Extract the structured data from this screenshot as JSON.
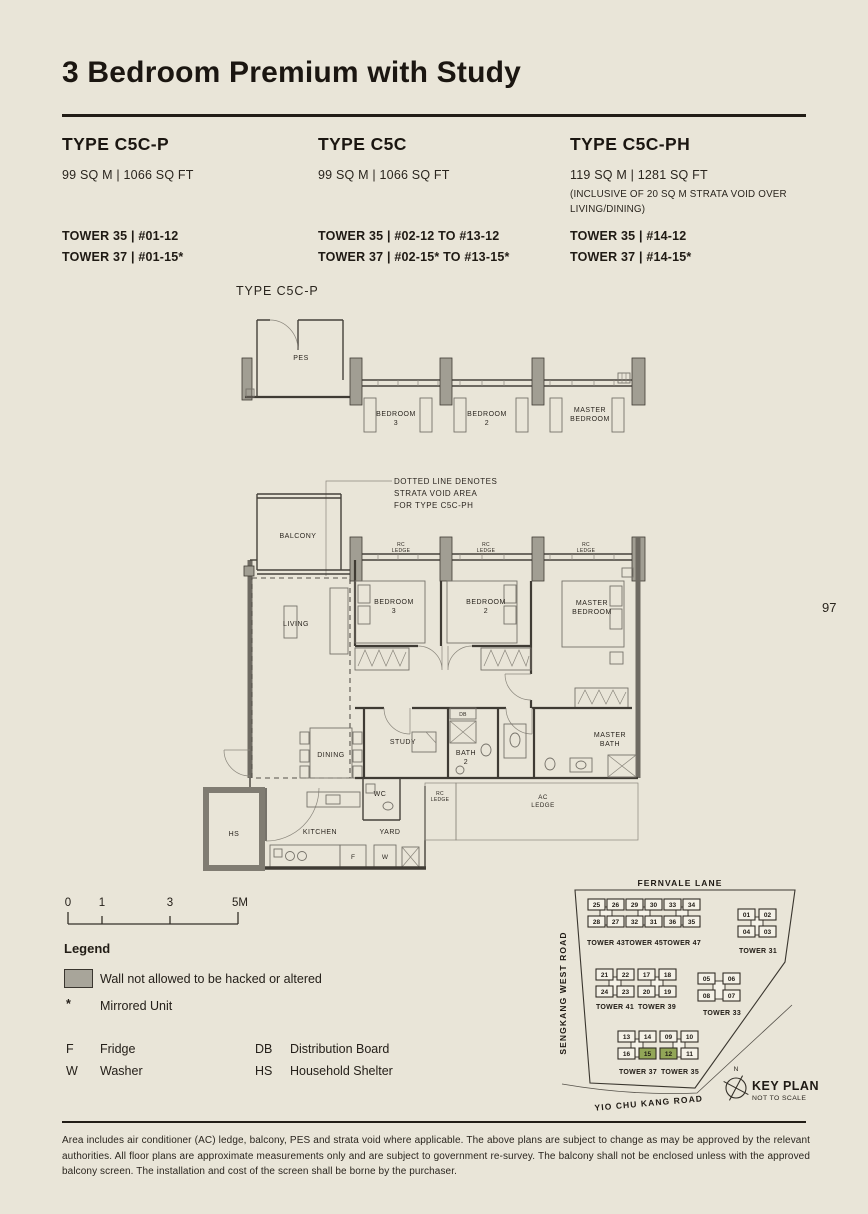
{
  "page": {
    "title": "3 Bedroom Premium with Study",
    "page_number": "97"
  },
  "unit_types": [
    {
      "name": "TYPE C5C-P",
      "area": "99 SQ M | 1066 SQ FT",
      "note": "",
      "towers": [
        "TOWER 35 | #01-12",
        "TOWER 37 | #01-15*"
      ]
    },
    {
      "name": "TYPE C5C",
      "area": "99 SQ M | 1066 SQ FT",
      "note": "",
      "towers": [
        "TOWER 35 | #02-12 TO #13-12",
        "TOWER 37 | #02-15* TO #13-15*"
      ]
    },
    {
      "name": "TYPE C5C-PH",
      "area": "119 SQ M | 1281 SQ FT",
      "note": "(INCLUSIVE OF 20 SQ M STRATA VOID OVER LIVING/DINING)",
      "towers": [
        "TOWER 35 | #14-12",
        "TOWER 37 | #14-15*"
      ]
    }
  ],
  "floorplan": {
    "label": "TYPE C5C-P",
    "annotation": [
      "DOTTED LINE DENOTES",
      "STRATA VOID AREA",
      "FOR TYPE C5C-PH"
    ],
    "rooms": {
      "pes": "PES",
      "balcony": "BALCONY",
      "living": "LIVING",
      "dining": "DINING",
      "kitchen": "KITCHEN",
      "yard": "YARD",
      "wc": "WC",
      "hs": "HS",
      "study": "STUDY",
      "db": "DB",
      "bath2": [
        "BATH",
        "2"
      ],
      "master_bath": [
        "MASTER",
        "BATH"
      ],
      "bedroom3": [
        "BEDROOM",
        "3"
      ],
      "bedroom2": [
        "BEDROOM",
        "2"
      ],
      "master_bedroom": [
        "MASTER",
        "BEDROOM"
      ],
      "rc_ledge": [
        "RC",
        "LEDGE"
      ],
      "ac_ledge": [
        "AC",
        "LEDGE"
      ],
      "fridge": "F",
      "washer": "W"
    }
  },
  "scale_bar": {
    "ticks": [
      "0",
      "1",
      "3",
      "5M"
    ]
  },
  "legend": {
    "title": "Legend",
    "wall_note": "Wall not allowed to be hacked or altered",
    "mirror_symbol": "*",
    "mirror_note": "Mirrored Unit",
    "abbreviations": [
      {
        "abbr": "F",
        "label": "Fridge"
      },
      {
        "abbr": "W",
        "label": "Washer"
      },
      {
        "abbr": "DB",
        "label": "Distribution Board"
      },
      {
        "abbr": "HS",
        "label": "Household Shelter"
      }
    ]
  },
  "key_plan": {
    "roads": {
      "top": "FERNVALE LANE",
      "left": "SENGKANG WEST ROAD",
      "bottom": "YIO CHU KANG ROAD"
    },
    "title": "KEY PLAN",
    "subtitle": "NOT TO SCALE",
    "north": "N",
    "highlight_color": "#92a657",
    "highlighted_units": [
      "15",
      "12"
    ],
    "clusters": [
      {
        "rows": [
          [
            "25",
            "26",
            "29",
            "30",
            "33",
            "34"
          ],
          [
            "28",
            "27",
            "32",
            "31",
            "36",
            "35"
          ]
        ],
        "towers": [
          "TOWER 43",
          "TOWER 45",
          "TOWER 47"
        ]
      },
      {
        "rows": [
          [
            "01",
            "02"
          ],
          [
            "04",
            "03"
          ]
        ],
        "towers": [
          "TOWER 31"
        ]
      },
      {
        "rows": [
          [
            "21",
            "22",
            "17",
            "18"
          ],
          [
            "24",
            "23",
            "20",
            "19"
          ]
        ],
        "towers": [
          "TOWER 41",
          "TOWER 39"
        ]
      },
      {
        "rows": [
          [
            "05",
            "06"
          ],
          [
            "08",
            "07"
          ]
        ],
        "towers": [
          "TOWER 33"
        ]
      },
      {
        "rows": [
          [
            "13",
            "14",
            "09",
            "10"
          ],
          [
            "16",
            "15",
            "12",
            "11"
          ]
        ],
        "towers": [
          "TOWER 37",
          "TOWER 35"
        ]
      }
    ]
  },
  "footer": {
    "disclaimer": "Area includes air conditioner (AC) ledge, balcony, PES and strata void where applicable. The above plans are subject to change as may be approved by the relevant authorities. All floor plans are approximate measurements only and are subject to government re-survey. The balcony shall not be enclosed unless with the approved balcony screen. The installation and cost of the screen shall be borne by the purchaser."
  }
}
